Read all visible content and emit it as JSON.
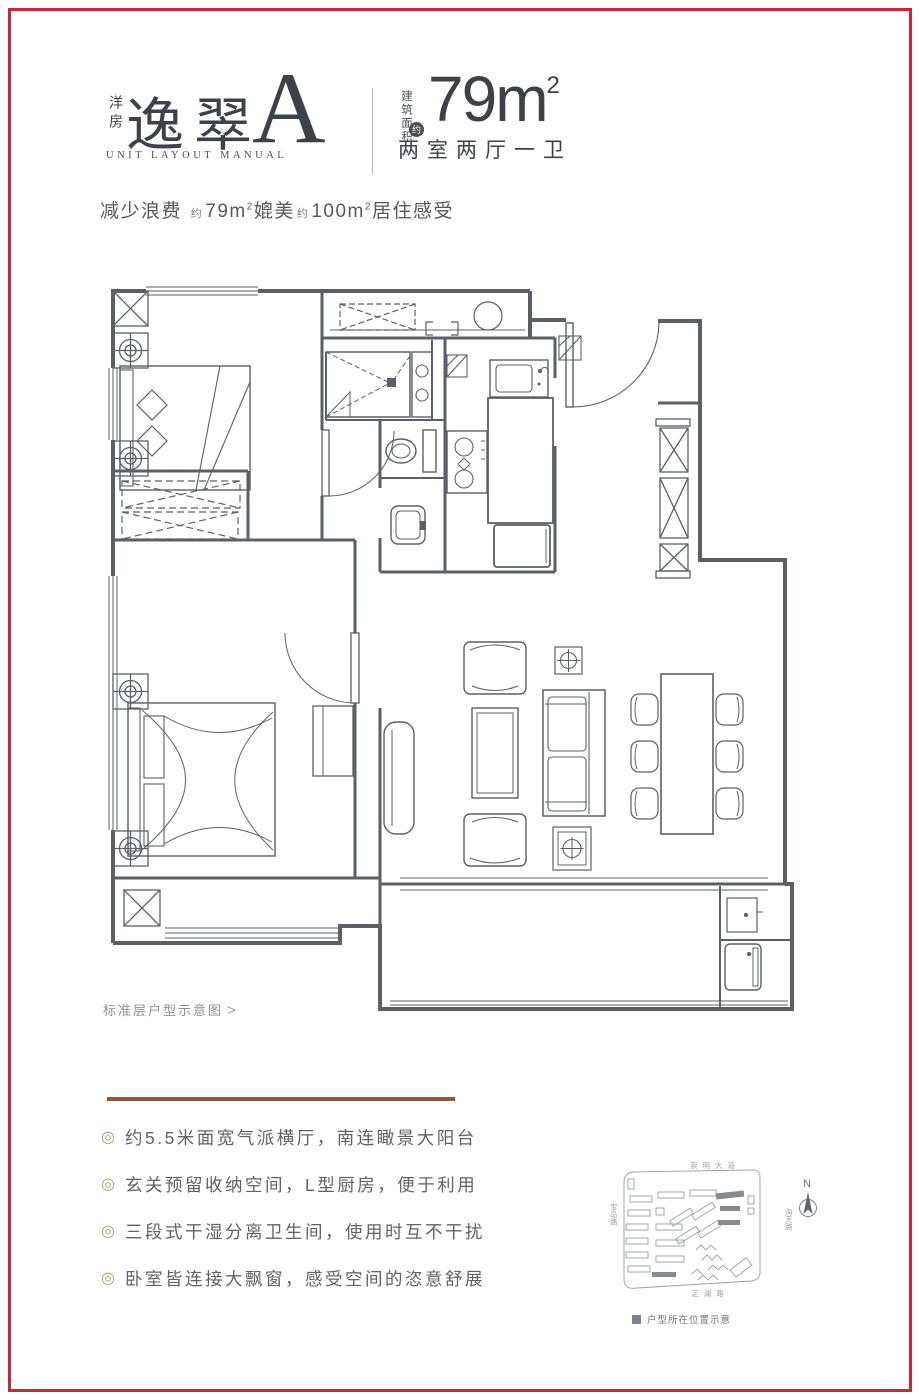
{
  "colors": {
    "border_red": "#c2293a",
    "divider_brown": "#8a5a3e",
    "bullet_gold": "#b29d72",
    "plan_line": "#5b6067",
    "text_dark": "#3d4248",
    "text_gray": "#5f6368"
  },
  "header": {
    "product_type": "洋房",
    "name": "逸翠",
    "unit": "A",
    "manual": "UNIT LAYOUT MANUAL",
    "area_label": "建筑面积",
    "approx_badge": "约",
    "area_value": "79",
    "area_unit": "m",
    "area_sup": "2",
    "layout_spec": "两室两厅一卫",
    "tagline": {
      "prefix": "减少浪费",
      "approx1": "约",
      "v1": "79m",
      "v1sup": "2",
      "mid": "媲美",
      "approx2": "约",
      "v2": "100m",
      "v2sup": "2",
      "suffix": "居住感受"
    }
  },
  "plan": {
    "caption": "标准层户型示意图",
    "caption_arrow": ">"
  },
  "features": {
    "bullet": "◎",
    "items": [
      "约5.5米面宽气派横厅，南连瞰景大阳台",
      "玄关预留收纳空间，L型厨房，便于利用",
      "三段式干湿分离卫生间，使用时互不干扰",
      "卧室皆连接大飘窗，感受空间的恣意舒展"
    ]
  },
  "map": {
    "roads": {
      "top": "崇明大道",
      "left": "宝岛路",
      "right": "海天路",
      "bottom": "定澜路"
    },
    "compass": "N",
    "legend": "户型所在位置示意"
  }
}
